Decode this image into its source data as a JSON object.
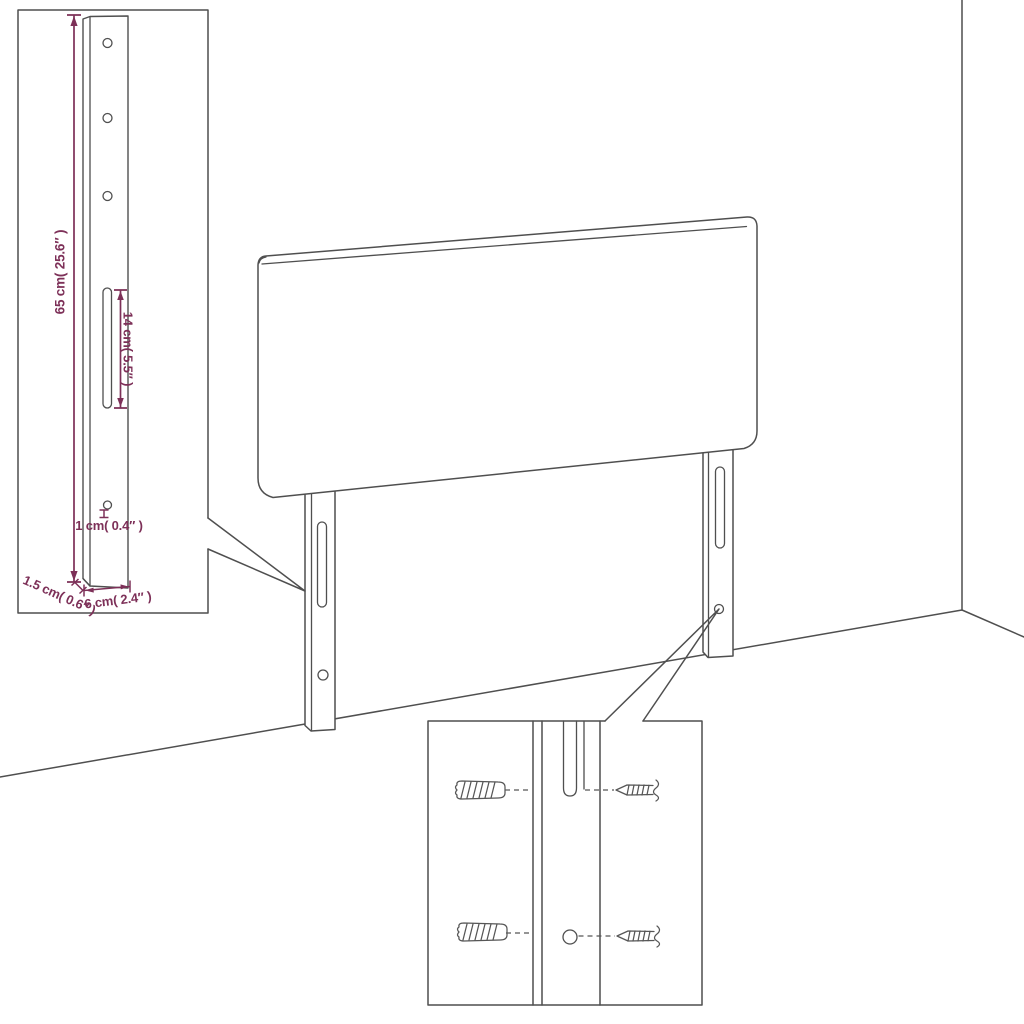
{
  "diagram": {
    "kind": "furniture-assembly-line-diagram",
    "subject": "upholstered headboard with two adjustable mounting legs shown against a wall corner",
    "colors": {
      "line": "#4f4f4f",
      "dimension": "#7d3058",
      "background": "#ffffff"
    },
    "leg_detail_inset": {
      "height_label": "65 cm( 25.6″ )",
      "slot_length_label": "14 cm( 5.5″ )",
      "hole_diameter_label": "1 cm( 0.4″ )",
      "depth_label": "1.5 cm( 0.6″ )",
      "width_label": "6 cm( 2.4″ )"
    }
  }
}
